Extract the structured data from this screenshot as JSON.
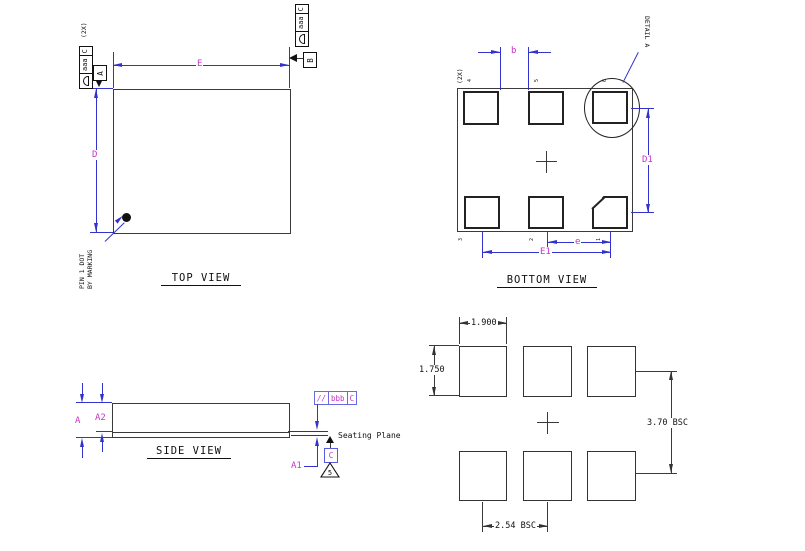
{
  "top_view": {
    "title": "TOP VIEW",
    "dim_width": "E",
    "dim_height": "D",
    "datum_a": "A",
    "datum_b": "B",
    "qty_note": "(2X)",
    "fcf_left": {
      "symbol": "profile-of-surface",
      "tolerance": "aaa",
      "datum": "C"
    },
    "fcf_right": {
      "symbol": "profile-of-surface",
      "tolerance": "aaa",
      "datum": "C"
    },
    "pin1_note_line1": "PIN 1 DOT",
    "pin1_note_line2": "BY MARKING"
  },
  "bottom_view": {
    "title": "BOTTOM VIEW",
    "dim_pad": "b",
    "dim_pitch": "e",
    "dim_span": "E1",
    "dim_row_pitch": "D1",
    "qty_note": "(2X)",
    "detail_label": "DETAIL A",
    "pins_top": [
      "4",
      "5",
      "6"
    ],
    "pins_bottom": [
      "3",
      "2",
      "1"
    ]
  },
  "side_view": {
    "title": "SIDE VIEW",
    "dim_overall": "A",
    "dim_body": "A2",
    "dim_standoff": "A1",
    "fcf": {
      "symbol": "//",
      "tolerance": "bbb",
      "datum": "C"
    },
    "seating_plane_label": "Seating Plane",
    "datum_c": "C",
    "note_flag": "5"
  },
  "land_pattern": {
    "pad_width": "1.900",
    "pad_height": "1.750",
    "row_pitch": "3.70 BSC",
    "col_pitch": "2.54 BSC"
  },
  "colors": {
    "dimension_line": "#3232cd",
    "dimension_text": "#c832c8",
    "outline": "#3a3a3a"
  }
}
